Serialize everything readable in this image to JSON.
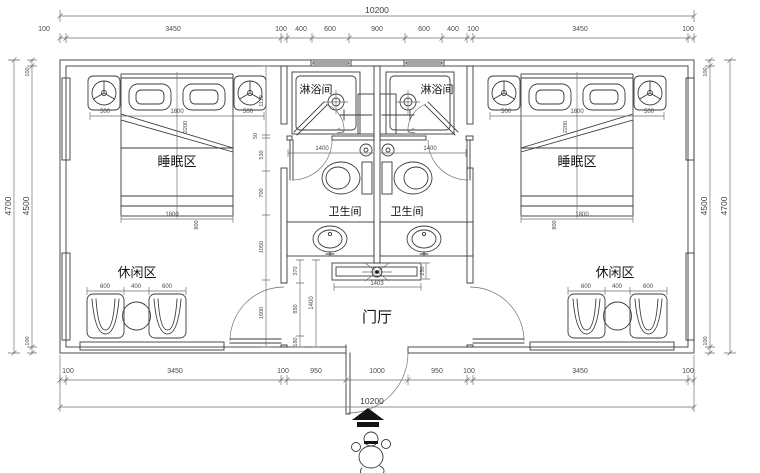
{
  "drawing": {
    "rooms": {
      "sleep": "睡眠区",
      "shower": "淋浴间",
      "toilet": "卫生间",
      "leisure": "休闲区",
      "foyer": "门厅"
    },
    "dims": {
      "top_total": "10200",
      "top": [
        "100",
        "3450",
        "100",
        "400",
        "600",
        "900",
        "600",
        "400",
        "100",
        "3450",
        "100"
      ],
      "bottom": [
        "100",
        "3450",
        "100",
        "950",
        "1000",
        "950",
        "100",
        "3450",
        "100"
      ],
      "bottom_total": "10200",
      "left_outer": "4700",
      "left_inner": "4500",
      "left_top": "100",
      "left_bottom": "100",
      "right_outer": "4700",
      "right_inner": "4500",
      "right_top": "100",
      "right_bottom": "100",
      "mid_chain": [
        "1110",
        "50",
        "530",
        "700",
        "1050",
        "1600"
      ],
      "foyer_chain": [
        "370",
        "850",
        "180"
      ],
      "foyer_depth": "1400",
      "counter_width": "1403",
      "counter_depth": "250",
      "bed_row": [
        "500",
        "1800",
        "500"
      ],
      "bed_width": "1800",
      "bed_side": "800",
      "bed_diag": "2200",
      "leisure_row": [
        "600",
        "400",
        "600"
      ],
      "shower_width": "1400"
    }
  }
}
